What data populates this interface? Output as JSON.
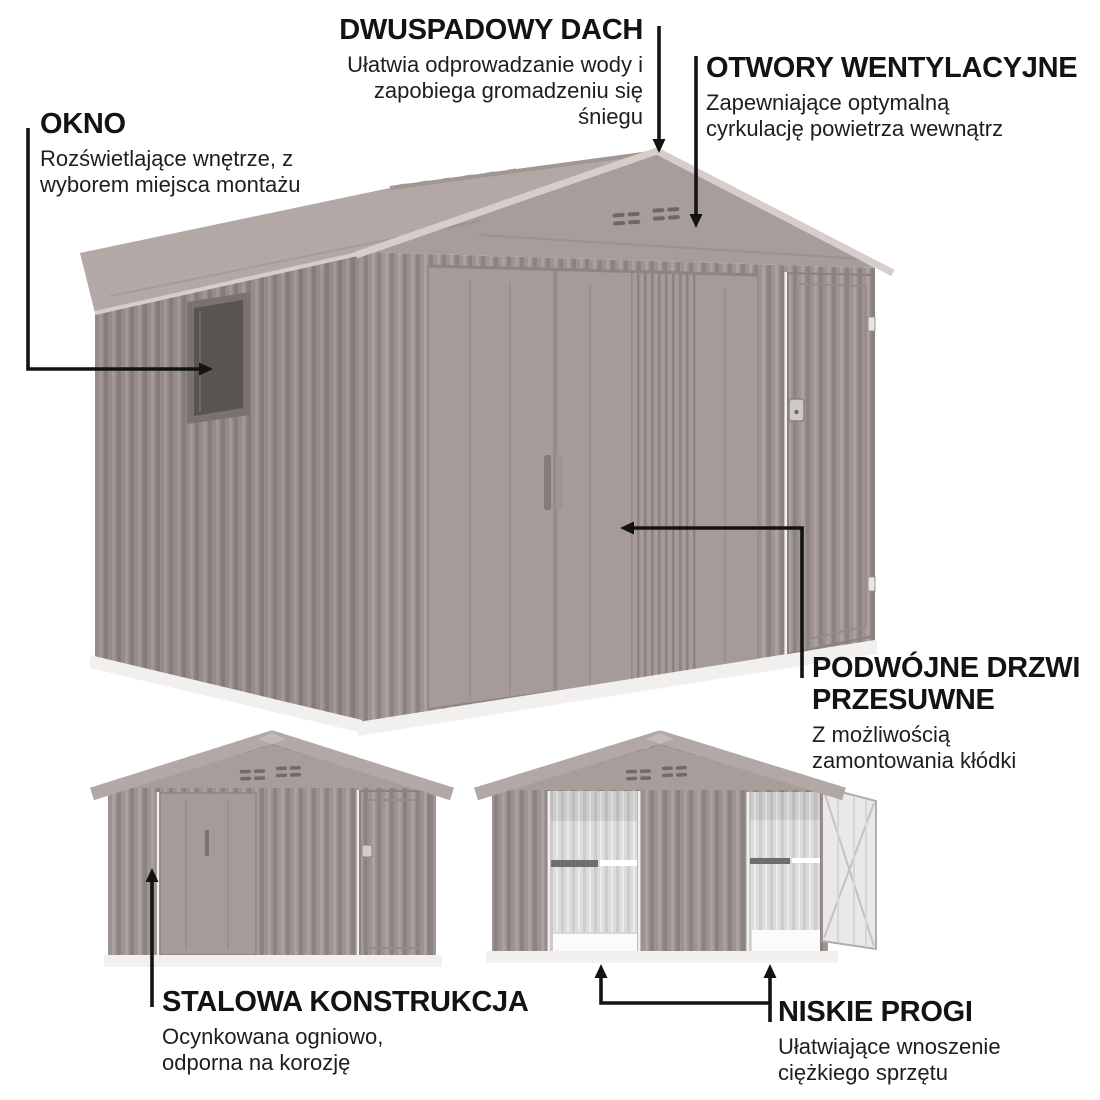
{
  "colors": {
    "text": "#131313",
    "arrow": "#131313",
    "wall": "#9d9391",
    "wallDark": "#8c8280",
    "wallLight": "#aba19e",
    "wallSmooth": "#a59b98",
    "gable": "#a79d9a",
    "roof": "#b2a8a5",
    "trim": "#d5cecb",
    "vent": "#675e5c",
    "glass": "#595352",
    "frame": "#7a7270",
    "interior": "#dcdcdc",
    "interiorRib": "#cccccc",
    "rail": "#6e6e6e",
    "floor": "#fbfbfb",
    "base": "#f2f0ef",
    "doorOpen": "#e9e9e9"
  },
  "annotations": {
    "roof": {
      "title": "DWUSPADOWY DACH",
      "lines": [
        "Ułatwia odprowadzanie wody i",
        "zapobiega gromadzeniu się",
        "śniegu"
      ]
    },
    "vents": {
      "title": "OTWORY WENTYLACYJNE",
      "lines": [
        "Zapewniające optymalną",
        "cyrkulację powietrza wewnątrz"
      ]
    },
    "window": {
      "title": "OKNO",
      "lines": [
        "Rozświetlające wnętrze, z",
        "wyborem miejsca montażu"
      ]
    },
    "doors": {
      "title": "PODWÓJNE DRZWI PRZESUWNE",
      "lines": [
        "Z możliwością",
        "zamontowania kłódki"
      ]
    },
    "steel": {
      "title": "STALOWA KONSTRUKCJA",
      "lines": [
        "Ocynkowana ogniowo,",
        "odporna na korozję"
      ]
    },
    "thresholds": {
      "title": "NISKIE PROGI",
      "lines": [
        "Ułatwiające wnoszenie",
        "ciężkiego sprzętu"
      ]
    }
  }
}
